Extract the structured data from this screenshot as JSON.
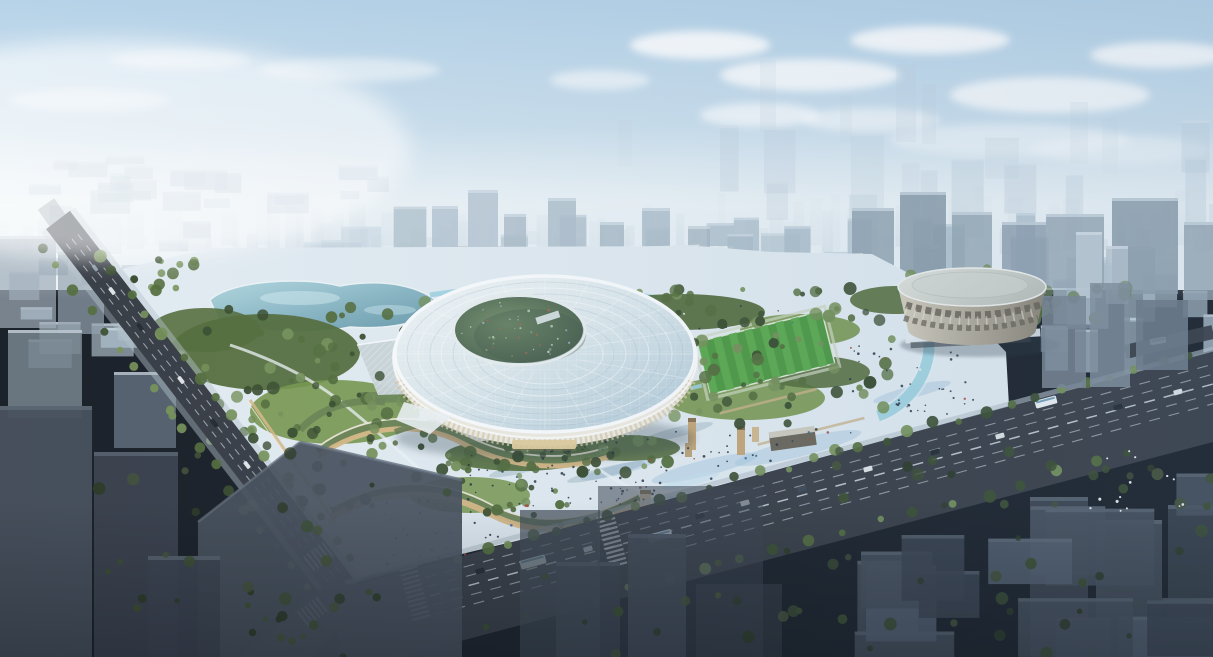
{
  "scene": {
    "domain": "natural-image",
    "description": "Aerial architectural rendering of a sports-park city block: an oval stadium with a glass lattice roof and offset bowl opening, a teal park lake, wooded gardens, curved terraced pavilions with warm glowing facades, a vast light pedestrian plaza with scattered visitors, a striped practice soccer field, stone relic towers, a round colonnaded gymnasium beside a stream, wide avenues with buses and cars, ghosted grey foreground towers, all under a hazy blue sky with clouds",
    "elements": [
      {
        "name": "sky",
        "label": "hazy blue sky with white clouds"
      },
      {
        "name": "distant-skyline",
        "label": "faint high-rise skyline in haze"
      },
      {
        "name": "city-mid",
        "label": "pale mid-ground city blocks with greenery"
      },
      {
        "name": "site-plaza",
        "label": "light pedestrian plaza with blue water streaks"
      },
      {
        "name": "lake",
        "label": "park lake"
      },
      {
        "name": "park-trees",
        "label": "park tree clusters"
      },
      {
        "name": "glass-pavilion",
        "label": "low glass pavilion with diagonal lattice"
      },
      {
        "name": "terraced-pavilions",
        "label": "curved terraced pavilions with green roofs and glowing fronts"
      },
      {
        "name": "main-stadium",
        "label": "oval stadium with concentric glass-grid roof"
      },
      {
        "name": "stadium-bowl",
        "label": "offset stadium bowl opening"
      },
      {
        "name": "soccer-field",
        "label": "striped training soccer field"
      },
      {
        "name": "relic-towers",
        "label": "tan stone relic towers on the plaza"
      },
      {
        "name": "gymnasium-arena",
        "label": "round colonnaded gymnasium with flat roof"
      },
      {
        "name": "stream",
        "label": "stream flowing past the gymnasium"
      },
      {
        "name": "elevated-station",
        "label": "elevated rail deck at the north edge"
      },
      {
        "name": "avenues",
        "label": "wide avenues with lane markings, buses and cars"
      },
      {
        "name": "crosswalks",
        "label": "zebra crosswalks at the intersection"
      },
      {
        "name": "foreground-towers",
        "label": "dark ghosted foreground towers and blocks"
      },
      {
        "name": "crowd",
        "label": "scattered pedestrians on the plazas"
      },
      {
        "name": "birds",
        "label": "small flock of white birds lower right"
      }
    ]
  },
  "palette": {
    "sky_top": "#b7d3e8",
    "sky_mid": "#d3e4ef",
    "sky_horizon": "#ecf2f5",
    "haze": "#f2f7f9",
    "cloud": "#ffffff",
    "city_far": "#c3d2dd",
    "city_mid": "#aebfcb",
    "city_top": "#dde7ee",
    "city_tree": "#6e8660",
    "plaza": "#e3ecf2",
    "plaza_blue": "#a3c8de",
    "path_light": "#eff5f8",
    "lake_light": "#b2d8e0",
    "lake_deep": "#6497a9",
    "stream": "#9fd2e0",
    "grass": "#78984f",
    "tree_dark": "#3c4f31",
    "tree_mid": "#566f3e",
    "tree_light": "#77925a",
    "field": "#4f9a44",
    "field_stripe": "#5ead52",
    "stadium_facade": "#efece1",
    "colonnade": "#d6c9ae",
    "warm_glow": "#e7c48e",
    "roof_hi": "#f4f8f9",
    "roof_lo": "#b2cad8",
    "rim": "#fbfdfe",
    "bowl_light": "#79956f",
    "bowl_dark": "#465c4c",
    "pavilion": "#ccd6d9",
    "terrace_roof": "#6d8455",
    "terrace_face": "#d9ba88",
    "terrace_edge": "#f3ecdd",
    "relic": "#c7a87a",
    "arena_roof_hi": "#e3e6e0",
    "arena_roof_lo": "#bfc4bd",
    "arena_wall_hi": "#d6d0c0",
    "arena_wall_lo": "#8c8576",
    "arena_window": "#655f52",
    "rail": "#59616a",
    "road": "#3a3f47",
    "road_dark": "#2f343b",
    "lane": "#ccd4da",
    "sidewalk": "#b7c4cd",
    "ghost_1": "#49525e",
    "ghost_2": "#3d4551",
    "ghost_3": "#556070",
    "ghost_top": "#66717e",
    "vehicle": "#e9edf0",
    "car_dark": "#242b33",
    "bus": "#eef3f6",
    "bus_stripe": "#5b8fae",
    "people": "#2b3544",
    "people_red": "#a84a38",
    "people_blue": "#3c64a0",
    "bird": "#ffffff",
    "shadow": "#2c3a46"
  }
}
